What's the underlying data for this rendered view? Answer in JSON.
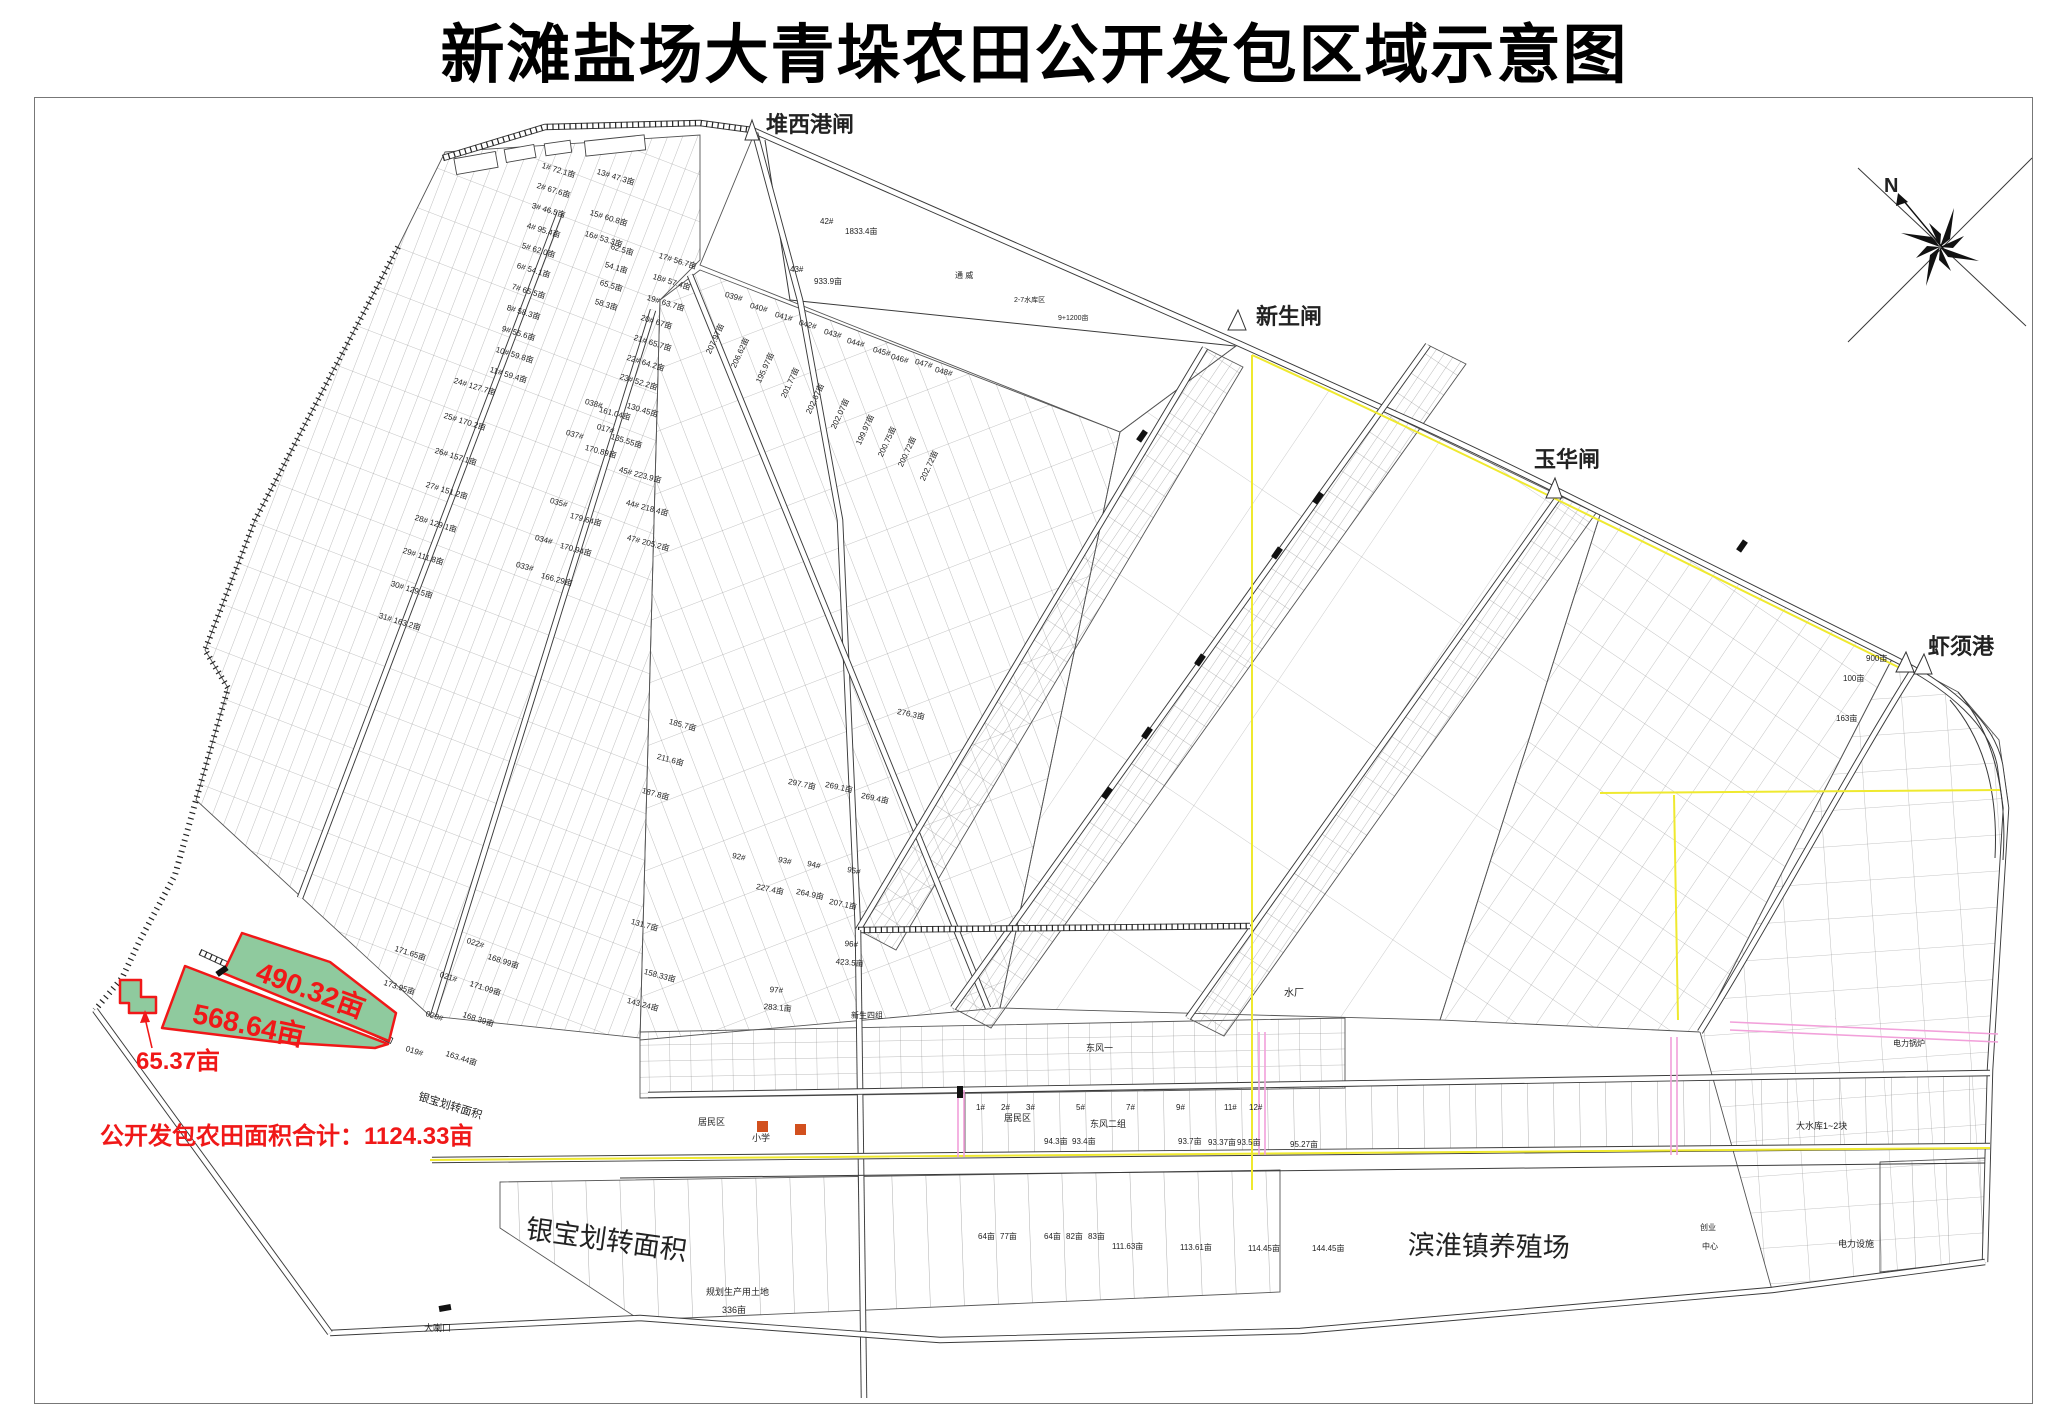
{
  "title": "新滩盐场大青垛农田公开发包区域示意图",
  "compass": {
    "north_label": "N"
  },
  "summary": {
    "total_label": "公开发包农田面积合计：1124.33亩"
  },
  "colors": {
    "highlight_fill": "#8fca9e",
    "highlight_stroke": "#f01818",
    "highlight_text": "#f01818",
    "boundary_yellow": "#efe92f",
    "road_pink": "#f2a0da",
    "symbol_orange": "#d2501e"
  },
  "map": {
    "ports": [
      {
        "t": "堆西港闸",
        "x": 766,
        "y": 114,
        "s": 22,
        "b": 1
      },
      {
        "t": "新生闸",
        "x": 1256,
        "y": 306,
        "s": 22,
        "b": 1
      },
      {
        "t": "玉华闸",
        "x": 1534,
        "y": 449,
        "s": 22,
        "b": 1
      },
      {
        "t": "虾须港",
        "x": 1928,
        "y": 636,
        "s": 22,
        "b": 1
      }
    ],
    "highlighted_parcels": [
      {
        "t": "490.32亩",
        "x": 262,
        "y": 958,
        "r": 20,
        "s": 28,
        "c": "#f01818",
        "b": 1
      },
      {
        "t": "568.64亩",
        "x": 196,
        "y": 1000,
        "r": 12,
        "s": 28,
        "c": "#f01818",
        "b": 1
      },
      {
        "t": "65.37亩",
        "x": 136,
        "y": 1050,
        "s": 24,
        "c": "#f01818",
        "b": 1
      }
    ],
    "region_labels": [
      {
        "t": "银宝划转面积",
        "x": 420,
        "y": 1092,
        "r": 17,
        "s": 11
      },
      {
        "t": "银宝划转面积",
        "x": 528,
        "y": 1216,
        "r": 8,
        "s": 27
      },
      {
        "t": "滨淮镇养殖场",
        "x": 1408,
        "y": 1232,
        "r": 1,
        "s": 27
      },
      {
        "t": "大喇口",
        "x": 424,
        "y": 1324,
        "s": 9
      },
      {
        "t": "水厂",
        "x": 1284,
        "y": 989,
        "s": 10
      },
      {
        "t": "居民区",
        "x": 698,
        "y": 1118,
        "s": 9
      },
      {
        "t": "居民区",
        "x": 1004,
        "y": 1114,
        "s": 9
      },
      {
        "t": "小学",
        "x": 752,
        "y": 1134,
        "s": 9
      },
      {
        "t": "东风二组",
        "x": 1090,
        "y": 1120,
        "s": 9
      },
      {
        "t": "东风一",
        "x": 1086,
        "y": 1044,
        "s": 9
      },
      {
        "t": "新生四组",
        "x": 851,
        "y": 1012,
        "s": 8
      },
      {
        "t": "规划生产用土地",
        "x": 706,
        "y": 1288,
        "s": 9
      },
      {
        "t": "336亩",
        "x": 722,
        "y": 1306,
        "s": 9
      },
      {
        "t": "大水库1~2块",
        "x": 1796,
        "y": 1122,
        "s": 9
      },
      {
        "t": "电力锅炉",
        "x": 1893,
        "y": 1040,
        "s": 8
      },
      {
        "t": "电力设施",
        "x": 1838,
        "y": 1240,
        "s": 9
      },
      {
        "t": "创业",
        "x": 1700,
        "y": 1224,
        "s": 8
      },
      {
        "t": "中心",
        "x": 1702,
        "y": 1243,
        "s": 8
      },
      {
        "t": "通 威",
        "x": 955,
        "y": 272,
        "s": 8
      },
      {
        "t": "2-7水库区",
        "x": 1014,
        "y": 297,
        "s": 7
      },
      {
        "t": "9+1200亩",
        "x": 1058,
        "y": 315,
        "s": 7
      }
    ],
    "parcel_labels": [
      {
        "t": "1# 72.1亩",
        "x": 543,
        "y": 162,
        "r": 17
      },
      {
        "t": "2# 67.6亩",
        "x": 538,
        "y": 182,
        "r": 17
      },
      {
        "t": "3# 46.5亩",
        "x": 533,
        "y": 202,
        "r": 17
      },
      {
        "t": "4# 95.4亩",
        "x": 528,
        "y": 222,
        "r": 17
      },
      {
        "t": "5# 62.0亩",
        "x": 523,
        "y": 242,
        "r": 17
      },
      {
        "t": "6# 54.1亩",
        "x": 518,
        "y": 262,
        "r": 17
      },
      {
        "t": "7# 65.5亩",
        "x": 513,
        "y": 283,
        "r": 17
      },
      {
        "t": "8# 58.3亩",
        "x": 508,
        "y": 304,
        "r": 17
      },
      {
        "t": "9# 55.6亩",
        "x": 503,
        "y": 325,
        "r": 17
      },
      {
        "t": "10# 59.8亩",
        "x": 497,
        "y": 346,
        "r": 17
      },
      {
        "t": "11# 59.4亩",
        "x": 491,
        "y": 366,
        "r": 17
      },
      {
        "t": "13# 47.3亩",
        "x": 598,
        "y": 168,
        "r": 17
      },
      {
        "t": "15# 60.8亩",
        "x": 591,
        "y": 209,
        "r": 17
      },
      {
        "t": "16# 53.3亩",
        "x": 586,
        "y": 230,
        "r": 17
      },
      {
        "t": "17# 56.7亩",
        "x": 660,
        "y": 252,
        "r": 17
      },
      {
        "t": "18# 57.4亩",
        "x": 654,
        "y": 273,
        "r": 17
      },
      {
        "t": "19# 63.7亩",
        "x": 648,
        "y": 294,
        "r": 17
      },
      {
        "t": "20# 67亩",
        "x": 642,
        "y": 314,
        "r": 17
      },
      {
        "t": "21# 65.7亩",
        "x": 635,
        "y": 334,
        "r": 17
      },
      {
        "t": "22# 64.2亩",
        "x": 628,
        "y": 354,
        "r": 17
      },
      {
        "t": "23# 52.2亩",
        "x": 621,
        "y": 373,
        "r": 17
      },
      {
        "t": "62.5亩",
        "x": 612,
        "y": 243,
        "r": 17
      },
      {
        "t": "54.1亩",
        "x": 606,
        "y": 261,
        "r": 17
      },
      {
        "t": "65.5亩",
        "x": 601,
        "y": 279,
        "r": 17
      },
      {
        "t": "58.3亩",
        "x": 596,
        "y": 298,
        "r": 17
      },
      {
        "t": "24# 127.7亩",
        "x": 455,
        "y": 377,
        "r": 17
      },
      {
        "t": "25# 170.2亩",
        "x": 445,
        "y": 412,
        "r": 17
      },
      {
        "t": "26# 157.1亩",
        "x": 436,
        "y": 447,
        "r": 17
      },
      {
        "t": "27# 151.2亩",
        "x": 427,
        "y": 481,
        "r": 17
      },
      {
        "t": "28# 129.1亩",
        "x": 416,
        "y": 514,
        "r": 17
      },
      {
        "t": "29# 111.8亩",
        "x": 404,
        "y": 547,
        "r": 17
      },
      {
        "t": "30# 129.5亩",
        "x": 392,
        "y": 580,
        "r": 17
      },
      {
        "t": "31# 163.2亩",
        "x": 380,
        "y": 612,
        "r": 17
      },
      {
        "t": "130.45亩",
        "x": 628,
        "y": 402,
        "r": 17
      },
      {
        "t": "135.55亩",
        "x": 612,
        "y": 433,
        "r": 17
      },
      {
        "t": "017#",
        "x": 598,
        "y": 423,
        "r": 17
      },
      {
        "t": "039#",
        "x": 726,
        "y": 291,
        "r": 15
      },
      {
        "t": "040#",
        "x": 751,
        "y": 302,
        "r": 15
      },
      {
        "t": "041#",
        "x": 776,
        "y": 311,
        "r": 15
      },
      {
        "t": "042#",
        "x": 800,
        "y": 319,
        "r": 15
      },
      {
        "t": "043#",
        "x": 825,
        "y": 328,
        "r": 15
      },
      {
        "t": "044#",
        "x": 848,
        "y": 337,
        "r": 15
      },
      {
        "t": "045#",
        "x": 874,
        "y": 346,
        "r": 15
      },
      {
        "t": "046#",
        "x": 892,
        "y": 353,
        "r": 15
      },
      {
        "t": "047#",
        "x": 916,
        "y": 358,
        "r": 15
      },
      {
        "t": "048#",
        "x": 936,
        "y": 366,
        "r": 15
      },
      {
        "t": "207.97亩",
        "x": 705,
        "y": 352,
        "r": -65
      },
      {
        "t": "206.62亩",
        "x": 730,
        "y": 366,
        "r": -65
      },
      {
        "t": "195.97亩",
        "x": 755,
        "y": 381,
        "r": -65
      },
      {
        "t": "201.77亩",
        "x": 780,
        "y": 396,
        "r": -65
      },
      {
        "t": "202.67亩",
        "x": 805,
        "y": 412,
        "r": -65
      },
      {
        "t": "202.07亩",
        "x": 830,
        "y": 427,
        "r": -65
      },
      {
        "t": "199.97亩",
        "x": 855,
        "y": 443,
        "r": -65
      },
      {
        "t": "200.75亩",
        "x": 877,
        "y": 455,
        "r": -65
      },
      {
        "t": "200.72亩",
        "x": 897,
        "y": 465,
        "r": -65
      },
      {
        "t": "202.72亩",
        "x": 919,
        "y": 479,
        "r": -65
      },
      {
        "t": "038#",
        "x": 586,
        "y": 398,
        "r": 15
      },
      {
        "t": "161.04亩",
        "x": 600,
        "y": 406,
        "r": 15
      },
      {
        "t": "037#",
        "x": 567,
        "y": 429,
        "r": 15
      },
      {
        "t": "170.89亩",
        "x": 586,
        "y": 444,
        "r": 15
      },
      {
        "t": "035#",
        "x": 551,
        "y": 497,
        "r": 15
      },
      {
        "t": "179.64亩",
        "x": 571,
        "y": 512,
        "r": 15
      },
      {
        "t": "034#",
        "x": 536,
        "y": 534,
        "r": 15
      },
      {
        "t": "170.94亩",
        "x": 561,
        "y": 542,
        "r": 15
      },
      {
        "t": "033#",
        "x": 517,
        "y": 561,
        "r": 15
      },
      {
        "t": "166.29亩",
        "x": 542,
        "y": 572,
        "r": 15
      },
      {
        "t": "45# 223.9亩",
        "x": 620,
        "y": 466,
        "r": 15
      },
      {
        "t": "44# 218.4亩",
        "x": 627,
        "y": 499,
        "r": 15
      },
      {
        "t": "47# 205.2亩",
        "x": 628,
        "y": 534,
        "r": 15
      },
      {
        "t": "42#",
        "x": 820,
        "y": 218
      },
      {
        "t": "1833.4亩",
        "x": 845,
        "y": 228
      },
      {
        "t": "43#",
        "x": 790,
        "y": 266
      },
      {
        "t": "933.9亩",
        "x": 814,
        "y": 278
      },
      {
        "t": "185.7亩",
        "x": 670,
        "y": 718,
        "r": 15
      },
      {
        "t": "211.6亩",
        "x": 658,
        "y": 753,
        "r": 15
      },
      {
        "t": "187.8亩",
        "x": 643,
        "y": 787,
        "r": 15
      },
      {
        "t": "131.7亩",
        "x": 632,
        "y": 918,
        "r": 15
      },
      {
        "t": "158.33亩",
        "x": 645,
        "y": 968,
        "r": 15
      },
      {
        "t": "143.24亩",
        "x": 628,
        "y": 997,
        "r": 15
      },
      {
        "t": "92#",
        "x": 733,
        "y": 852,
        "r": 12
      },
      {
        "t": "227.4亩",
        "x": 757,
        "y": 883,
        "r": 12
      },
      {
        "t": "93#",
        "x": 779,
        "y": 856,
        "r": 12
      },
      {
        "t": "264.9亩",
        "x": 797,
        "y": 888,
        "r": 12
      },
      {
        "t": "94#",
        "x": 808,
        "y": 860,
        "r": 12
      },
      {
        "t": "95#",
        "x": 848,
        "y": 866,
        "r": 12
      },
      {
        "t": "207.1亩",
        "x": 830,
        "y": 898,
        "r": 12
      },
      {
        "t": "96#",
        "x": 845,
        "y": 940,
        "r": 5
      },
      {
        "t": "423.5亩",
        "x": 836,
        "y": 958,
        "r": 5
      },
      {
        "t": "97#",
        "x": 770,
        "y": 986,
        "r": 5
      },
      {
        "t": "283.1亩",
        "x": 764,
        "y": 1003,
        "r": 5
      },
      {
        "t": "297.7亩",
        "x": 789,
        "y": 778,
        "r": 12
      },
      {
        "t": "269.1亩",
        "x": 826,
        "y": 781,
        "r": 12
      },
      {
        "t": "269.4亩",
        "x": 862,
        "y": 792,
        "r": 12
      },
      {
        "t": "276.3亩",
        "x": 898,
        "y": 708,
        "r": 12
      },
      {
        "t": "022#",
        "x": 468,
        "y": 937,
        "r": 18
      },
      {
        "t": "171.65亩",
        "x": 396,
        "y": 945,
        "r": 18
      },
      {
        "t": "168.99亩",
        "x": 489,
        "y": 953,
        "r": 18
      },
      {
        "t": "021#",
        "x": 441,
        "y": 971,
        "r": 18
      },
      {
        "t": "173.95亩",
        "x": 385,
        "y": 979,
        "r": 18
      },
      {
        "t": "171.09亩",
        "x": 471,
        "y": 980,
        "r": 18
      },
      {
        "t": "020#",
        "x": 427,
        "y": 1010,
        "r": 18
      },
      {
        "t": "168.39亩",
        "x": 464,
        "y": 1011,
        "r": 18
      },
      {
        "t": "019#",
        "x": 407,
        "y": 1045,
        "r": 18
      },
      {
        "t": "163.44亩",
        "x": 447,
        "y": 1050,
        "r": 18
      },
      {
        "t": "900亩",
        "x": 1866,
        "y": 655
      },
      {
        "t": "100亩",
        "x": 1843,
        "y": 675
      },
      {
        "t": "163亩",
        "x": 1836,
        "y": 715
      },
      {
        "t": "1#",
        "x": 976,
        "y": 1104
      },
      {
        "t": "2#",
        "x": 1001,
        "y": 1104
      },
      {
        "t": "3#",
        "x": 1026,
        "y": 1104
      },
      {
        "t": "5#",
        "x": 1076,
        "y": 1104
      },
      {
        "t": "7#",
        "x": 1126,
        "y": 1104
      },
      {
        "t": "9#",
        "x": 1176,
        "y": 1104
      },
      {
        "t": "11#",
        "x": 1224,
        "y": 1104
      },
      {
        "t": "12#",
        "x": 1249,
        "y": 1104
      },
      {
        "t": "94.3亩",
        "x": 1044,
        "y": 1138
      },
      {
        "t": "93.4亩",
        "x": 1072,
        "y": 1138
      },
      {
        "t": "93.7亩",
        "x": 1178,
        "y": 1138
      },
      {
        "t": "93.37亩",
        "x": 1208,
        "y": 1139
      },
      {
        "t": "93.5亩",
        "x": 1237,
        "y": 1139
      },
      {
        "t": "95.27亩",
        "x": 1290,
        "y": 1141
      },
      {
        "t": "64亩",
        "x": 978,
        "y": 1233
      },
      {
        "t": "77亩",
        "x": 1000,
        "y": 1233
      },
      {
        "t": "64亩",
        "x": 1044,
        "y": 1233
      },
      {
        "t": "82亩",
        "x": 1066,
        "y": 1233
      },
      {
        "t": "83亩",
        "x": 1088,
        "y": 1233
      },
      {
        "t": "111.63亩",
        "x": 1112,
        "y": 1243
      },
      {
        "t": "113.61亩",
        "x": 1180,
        "y": 1244
      },
      {
        "t": "114.45亩",
        "x": 1248,
        "y": 1245
      },
      {
        "t": "144.45亩",
        "x": 1312,
        "y": 1245
      }
    ]
  }
}
